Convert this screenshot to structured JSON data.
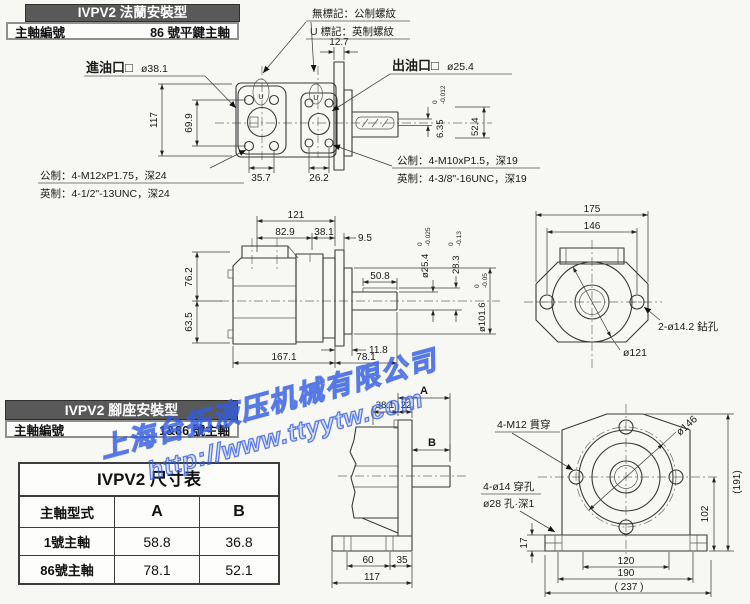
{
  "flange_section": {
    "header_title": "IVPV2 法蘭安裝型",
    "shaft_label": "主軸編號",
    "shaft_value": "86 號平鍵主軸",
    "note_no_mark": "無標記：公制螺紋",
    "note_u_mark": "U 標記：英制螺紋",
    "u_glyph": "U",
    "inlet_label": "進油口□",
    "inlet_dia": "ø38.1",
    "outlet_label": "出油口□",
    "outlet_dia": "ø25.4",
    "inlet_thread_metric": "公制：4-M12xP1.75，深24",
    "inlet_thread_imperial": "英制：4-1/2\"-13UNC，深24",
    "outlet_thread_metric": "公制：4-M10xP1.5，深19",
    "outlet_thread_imperial": "英制：4-3/8\"-16UNC，深19",
    "dims": {
      "boss_w": "12.7",
      "body_h": "117",
      "port_v": "69.9",
      "bolt_sp1": "35.7",
      "bolt_sp2": "26.2",
      "key_w": "6.35",
      "key_tol_hi": "0",
      "key_tol_lo": "-0.012",
      "shaft_len": "52.4"
    }
  },
  "side_view": {
    "dims": {
      "len_total_top": "121",
      "len_a": "82.9",
      "len_b": "38.1",
      "len_c": "9.5",
      "key_len": "50.8",
      "h_up": "76.2",
      "h_dn": "63.5",
      "t_flange": "11.8",
      "len_body": "167.1",
      "len_shaft": "78.1",
      "shaft_dia": "ø25.4",
      "shaft_tol_hi": "0",
      "shaft_tol_lo": "-0.025",
      "key_h": "28.3",
      "key_tol_hi": "0",
      "key_tol_lo": "-0.13",
      "pilot_dia": "ø101.6",
      "pilot_tol_hi": "0",
      "pilot_tol_lo": "-0.05"
    }
  },
  "rear_view": {
    "dims": {
      "w_outer": "175",
      "w_bolt": "146"
    },
    "holes_label": "2-ø14.2 鉆孔",
    "pilot_label": "ø121"
  },
  "foot_section": {
    "header_title": "IVPV2 腳座安裝型",
    "shaft_label": "主軸編號",
    "shaft_value": "1&86 號主軸",
    "bolt_label": "4-M12 貫穿",
    "bc_label": "ø146",
    "foot_hole_label1": "4-ø14 穿孔",
    "foot_hole_label2": "ø28 孔·深1",
    "dims_side": {
      "A": "A",
      "B": "B",
      "d1": "38.1",
      "d2": "22",
      "d3": "60",
      "d4": "35",
      "d5": "117"
    },
    "dims_front": {
      "h_total": "(191)",
      "h_center": "102",
      "pad_h": "17",
      "w1": "120",
      "w2": "190",
      "w3": "( 237 )"
    }
  },
  "size_table": {
    "title": "IVPV2 尺寸表",
    "headers": [
      "主軸型式",
      "A",
      "B"
    ],
    "rows": [
      [
        "1號主軸",
        "58.8",
        "36.8"
      ],
      [
        "86號主軸",
        "78.1",
        "52.1"
      ]
    ]
  },
  "watermark": {
    "company": "上海台拓液压机械有限公司",
    "url": "http://www.ttyytw.com"
  }
}
